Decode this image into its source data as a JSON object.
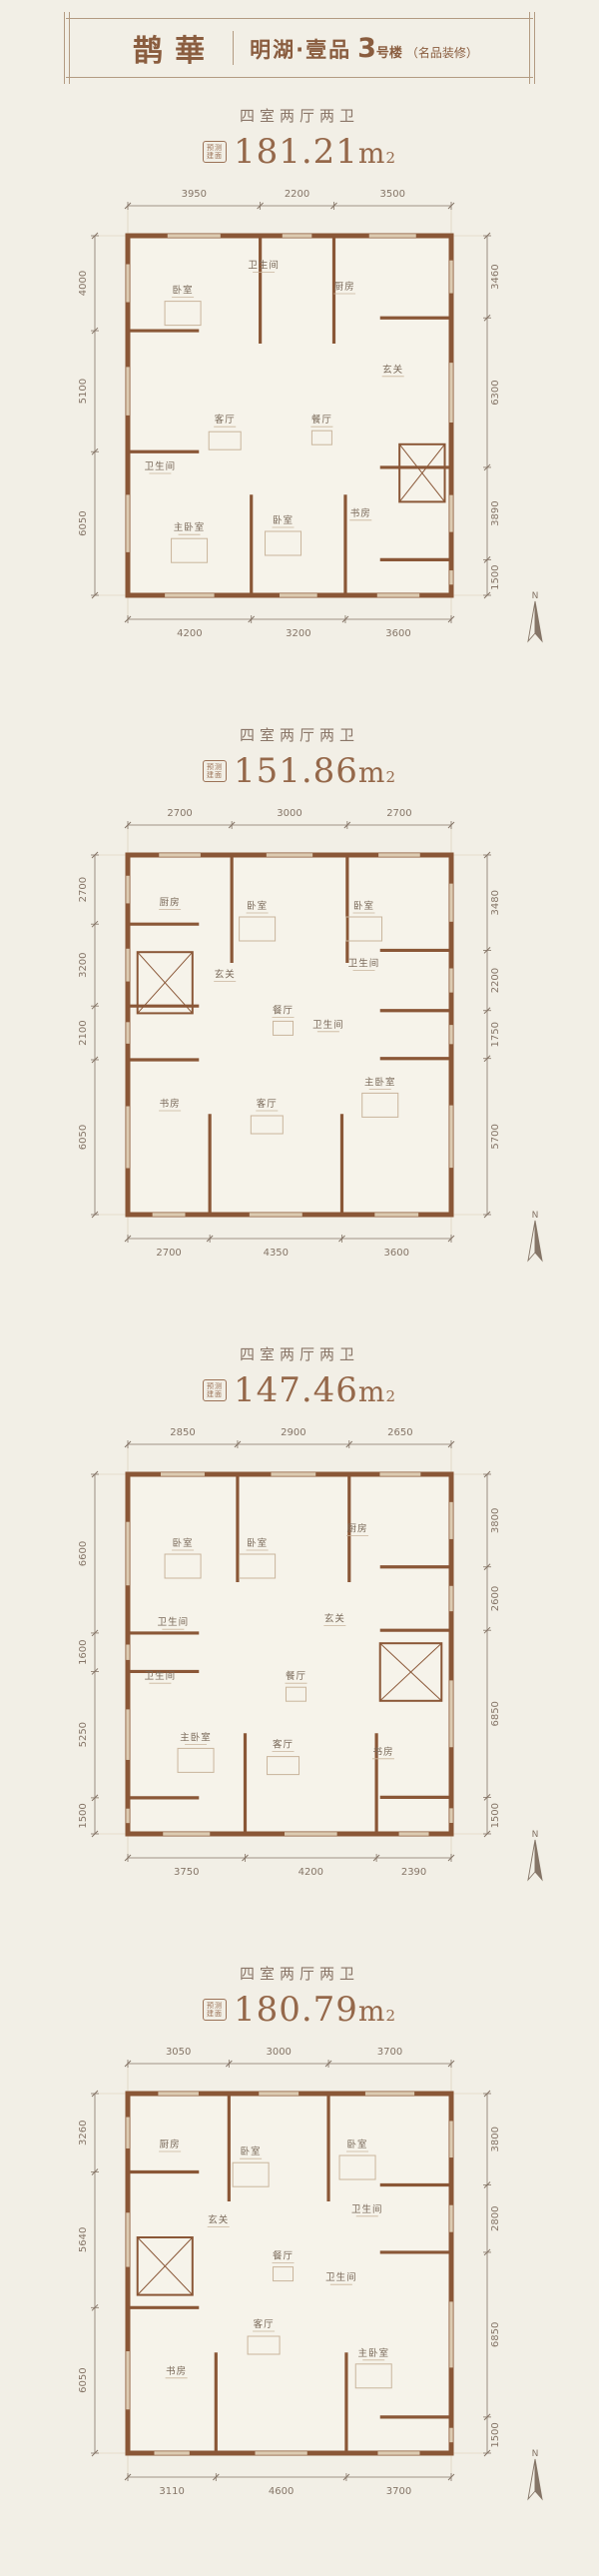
{
  "header": {
    "logo": "鹊華",
    "project": "明湖·壹品",
    "building_num": "3",
    "building_suffix": "号楼",
    "note": "（名品装修）"
  },
  "area_badge": [
    "预测",
    "建面"
  ],
  "north_label": "N",
  "plans": [
    {
      "layout": "四室两厅两卫",
      "area": "181.21",
      "area_unit": "m",
      "area_sup": "2",
      "dims": {
        "top": [
          "3950",
          "2200",
          "3500"
        ],
        "bottom": [
          "4200",
          "3200",
          "3600"
        ],
        "left": [
          "4000",
          "5100",
          "6050"
        ],
        "right": [
          "3460",
          "6300",
          "3890",
          "1500"
        ]
      },
      "rooms": [
        "卧室",
        "卫生间",
        "厨房",
        "玄关",
        "餐厅",
        "客厅",
        "卫生间",
        "主卧室",
        "卧室",
        "书房"
      ]
    },
    {
      "layout": "四室两厅两卫",
      "area": "151.86",
      "area_unit": "m",
      "area_sup": "2",
      "dims": {
        "top": [
          "2700",
          "3000",
          "2700"
        ],
        "bottom": [
          "2700",
          "4350",
          "3600"
        ],
        "left": [
          "2700",
          "3200",
          "2100",
          "6050"
        ],
        "right": [
          "3480",
          "2200",
          "1750",
          "5700"
        ]
      },
      "rooms": [
        "厨房",
        "卧室",
        "卧室",
        "玄关",
        "餐厅",
        "卫生间",
        "卫生间",
        "书房",
        "客厅",
        "主卧室"
      ]
    },
    {
      "layout": "四室两厅两卫",
      "area": "147.46",
      "area_unit": "m",
      "area_sup": "2",
      "dims": {
        "top": [
          "2850",
          "2900",
          "2650"
        ],
        "bottom": [
          "3750",
          "4200",
          "2390"
        ],
        "left": [
          "6600",
          "1600",
          "5250",
          "1500"
        ],
        "right": [
          "3800",
          "2600",
          "6850",
          "1500"
        ]
      },
      "rooms": [
        "卧室",
        "卧室",
        "厨房",
        "玄关",
        "卫生间",
        "餐厅",
        "卫生间",
        "主卧室",
        "客厅",
        "书房"
      ]
    },
    {
      "layout": "四室两厅两卫",
      "area": "180.79",
      "area_unit": "m",
      "area_sup": "2",
      "dims": {
        "top": [
          "3050",
          "3000",
          "3700"
        ],
        "bottom": [
          "3110",
          "4600",
          "3700"
        ],
        "left": [
          "3260",
          "5640",
          "6050"
        ],
        "right": [
          "3800",
          "2800",
          "6850",
          "1500"
        ]
      },
      "rooms": [
        "厨房",
        "卧室",
        "卧室",
        "玄关",
        "卫生间",
        "餐厅",
        "客厅",
        "卫生间",
        "书房",
        "主卧室"
      ]
    }
  ]
}
